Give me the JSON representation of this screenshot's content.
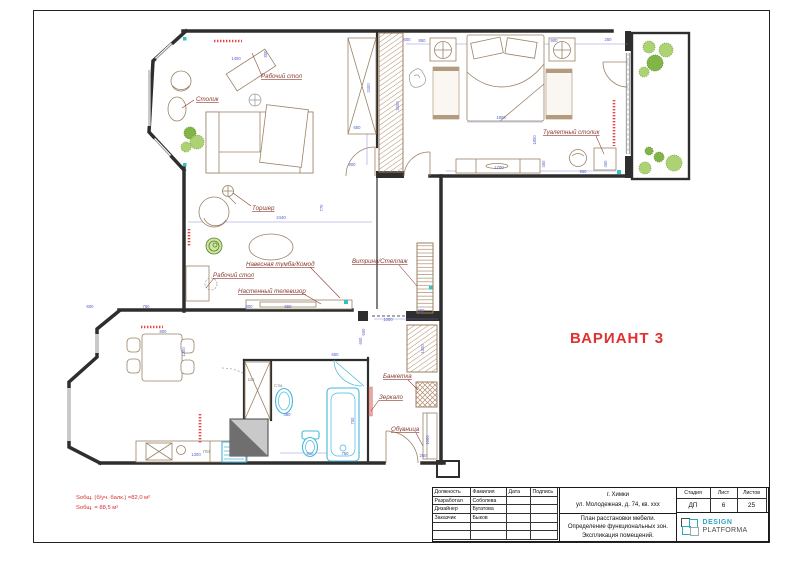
{
  "sheet": {
    "variant": "ВАРИАНТ 3",
    "area_line1": "Sобщ. (б/уч. балк.) =82,0  м²",
    "area_line2": "Sобщ. = 88,5 м²"
  },
  "plan": {
    "labels": [
      "Рабочий стол",
      "Столик",
      "Туалетный столик",
      "Торшер",
      "Навесная тумба/Комод",
      "Рабочий стол",
      "Настенный телевизор",
      "Витрина/Стеллаж",
      "Банкетка",
      "Зеркало",
      "Обувница"
    ],
    "small_labels": [
      "ПМ",
      "ШК",
      "Стм."
    ],
    "dims": [
      "1400",
      "800",
      "2400",
      "650",
      "800",
      "2440",
      "770",
      "3400",
      "600",
      "850",
      "900",
      "250",
      "1800",
      "1850",
      "1700",
      "450",
      "950",
      "450",
      "450",
      "1000",
      "600",
      "1300",
      "1000",
      "250",
      "600",
      "760",
      "800",
      "650",
      "800",
      "1200",
      "1300",
      "480",
      "910",
      "750",
      "700",
      "650",
      "600"
    ],
    "colors": {
      "walls": "#2e2e2e",
      "furniture": "#9b8266",
      "fixtures": "#45b8dc",
      "dims": "#5560c8",
      "annotation": "#8a3b30",
      "accent_red": "#e03030",
      "radiator": "#e84444",
      "plant_light": "#a8d06d",
      "plant_dark": "#7cb23e",
      "teal_marker": "#2ec4c4"
    }
  },
  "titleblock": {
    "personnel": [
      [
        "Должность",
        "Фамилия",
        "Дата",
        "Подпись"
      ],
      [
        "Разработал",
        "Соболева",
        "",
        ""
      ],
      [
        "Дизайнер",
        "Бугатова",
        "",
        ""
      ],
      [
        "Заказчик",
        "Быков",
        "",
        ""
      ],
      [
        "",
        "",
        "",
        ""
      ],
      [
        "",
        "",
        "",
        ""
      ]
    ],
    "address_line1": "г. Химки",
    "address_line2": "ул. Молодежная, д. 74, кв. xxx",
    "description": "План расстановки мебели. Определение функциональных зон. Экспликация помещений.",
    "stage_header": "Стадия",
    "sheet_header": "Лист",
    "sheets_header": "Листов",
    "stage": "ДП",
    "sheet_no": "6",
    "sheets_total": "25",
    "logo_line1": "DESIGN",
    "logo_line2": "PLATFORMA"
  }
}
